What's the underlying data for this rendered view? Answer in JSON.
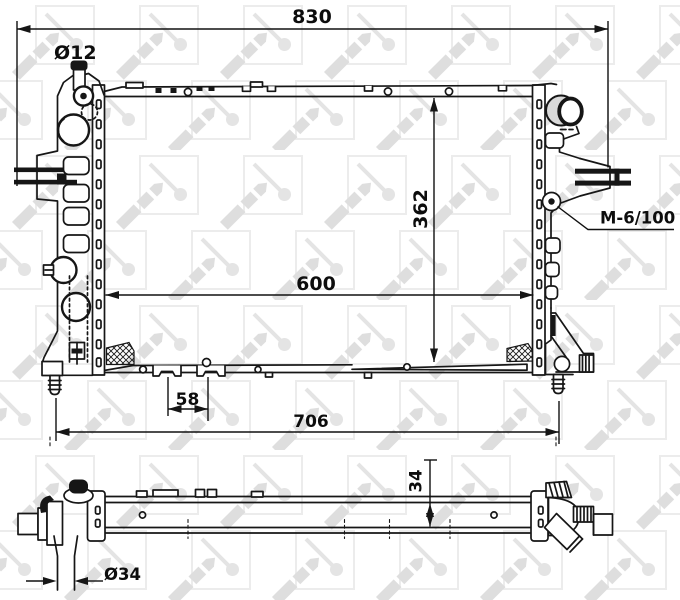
{
  "drawing": {
    "watermark_brand": "NRF",
    "labels": {
      "dim_overall_width": "830",
      "dim_inlet_neck_diameter": "Ø12",
      "dim_core_height": "362",
      "dim_core_width": "600",
      "thread_spec": "M-6/100",
      "dim_foot_spacing": "58",
      "dim_mounting_pin_span": "706",
      "dim_core_thickness": "34",
      "dim_bottom_pipe_diameter": "Ø34"
    },
    "colors": {
      "line": "#161616",
      "watermark": "#e3e3e3",
      "pipe_shade": "#d9d9d9",
      "background": "#ffffff"
    }
  }
}
